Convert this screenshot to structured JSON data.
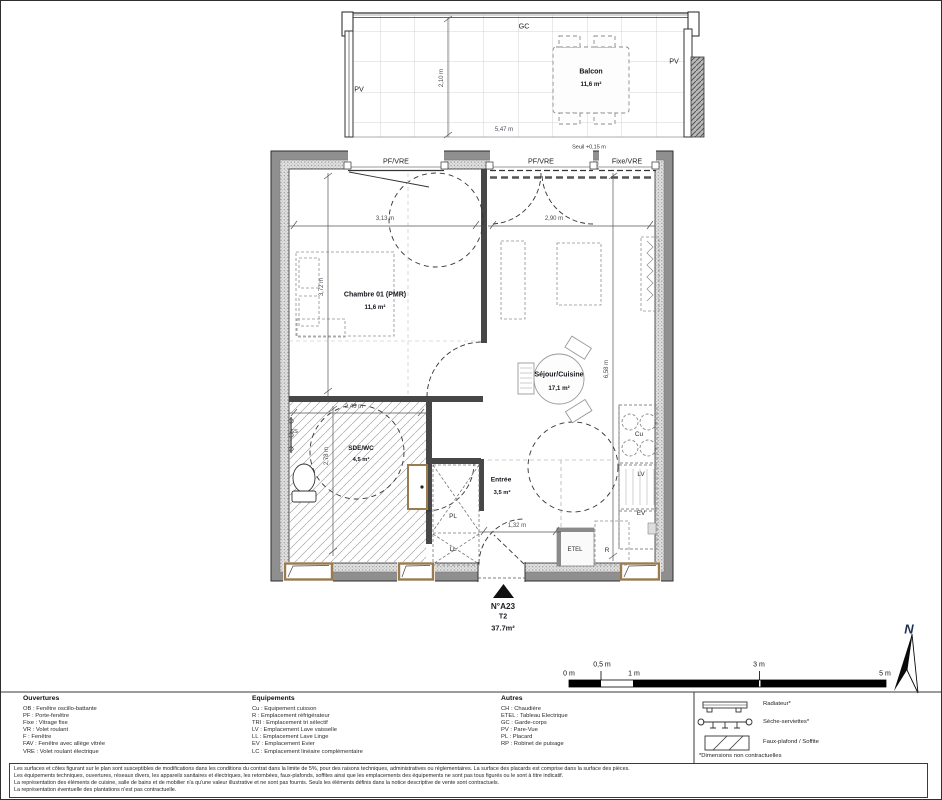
{
  "balcony": {
    "gc": "GC",
    "pv_left": "PV",
    "pv_right": "PV",
    "name": "Balcon",
    "area": "11,6 m²",
    "width": "5,47 m",
    "depth": "2,10 m",
    "seuil": "Seuil +0,15 m"
  },
  "windows": {
    "w1": "PF/VRE",
    "w2": "PF/VRE",
    "w3": "Fixe/VRE"
  },
  "rooms": {
    "chambre": {
      "name": "Chambre 01 (PMR)",
      "area": "11,6 m²",
      "w": "3,13 m",
      "h": "3,72 m"
    },
    "sejour": {
      "name": "Séjour/Cuisine",
      "area": "17,1 m²",
      "w": "2,90 m",
      "h": "6,58 m"
    },
    "sde": {
      "name": "SDE/WC",
      "area": "4,5 m²",
      "w": "2,46 m",
      "h": "2,78 m"
    },
    "entree": {
      "name": "Entrée",
      "area": "3,5 m²",
      "w": "1,32 m"
    }
  },
  "marks": {
    "ss": "SS",
    "pl": "PL",
    "ll": "LL",
    "etel": "ETEL",
    "r": "R",
    "cu": "Cu",
    "lv": "LV",
    "ev": "EV"
  },
  "title": {
    "lot": "N°A23",
    "type": "T2",
    "area": "37.7m²"
  },
  "scale": {
    "t0": "0 m",
    "t05": "0,5 m",
    "t1": "1 m",
    "t3": "3 m",
    "t5": "5 m"
  },
  "north": {
    "label": "N"
  },
  "legend": {
    "ouvertures": {
      "title": "Ouvertures",
      "items": [
        "OB : Fenêtre oscillo-battante",
        "PF : Porte-fenêtre",
        "Fixe : Vitrage fixe",
        "VR : Volet roulant",
        "F : Fenêtre",
        "FAV : Fenêtre avec allège vitrée",
        "VRE : Volet roulant électrique"
      ]
    },
    "equipements": {
      "title": "Equipements",
      "items": [
        "Cu : Equipement cuisson",
        "R : Emplacement réfrigérateur",
        "TRI : Emplacement tri sélectif",
        "LV : Emplacement Lave vaisselle",
        "LL : Emplacement Lave Linge",
        "EV : Emplacement Evier",
        "LC : Emplacement linéaire complémentaire"
      ]
    },
    "autres": {
      "title": "Autres",
      "items": [
        "CH : Chaudière",
        "ETEL : Tableau Electrique",
        "GC : Garde-corps",
        "PV : Pare-Vue",
        "PL : Placard",
        "RP : Robinet de puisage"
      ]
    },
    "symbols": {
      "radiateur": "Radiateur*",
      "seche_serviettes": "Sèche-serviettes*",
      "faux_plafond": "Faux-plafond / Soffite",
      "note": "*Dimensions non contractuelles"
    }
  },
  "disclaimer": {
    "l1": "Les surfaces et côtes figurant sur le plan sont susceptibles de modifications dans les conditions du contrat dans la limite de 5%, pour des raisons techniques, administratives ou réglementaires. La surface des placards est comprise dans la surface des pièces.",
    "l2": "Les équipements techniques, ouvertures, réseaux divers, les appareils sanitaires et électriques, les retombées, faux-plafonds, soffites ainsi que les emplacements des équipements ne sont pas tous figurés ou le sont à titre indicatif.",
    "l3": "La représentation des éléments de cuisine, salle de bains et de mobilier n'a qu'une valeur illustrative et ne sont pas fournis. Seuls les éléments définis dans la notice descriptive de vente sont contractuels.",
    "l4": "La représentation éventuelle des plantations n'est pas contractuelle."
  }
}
